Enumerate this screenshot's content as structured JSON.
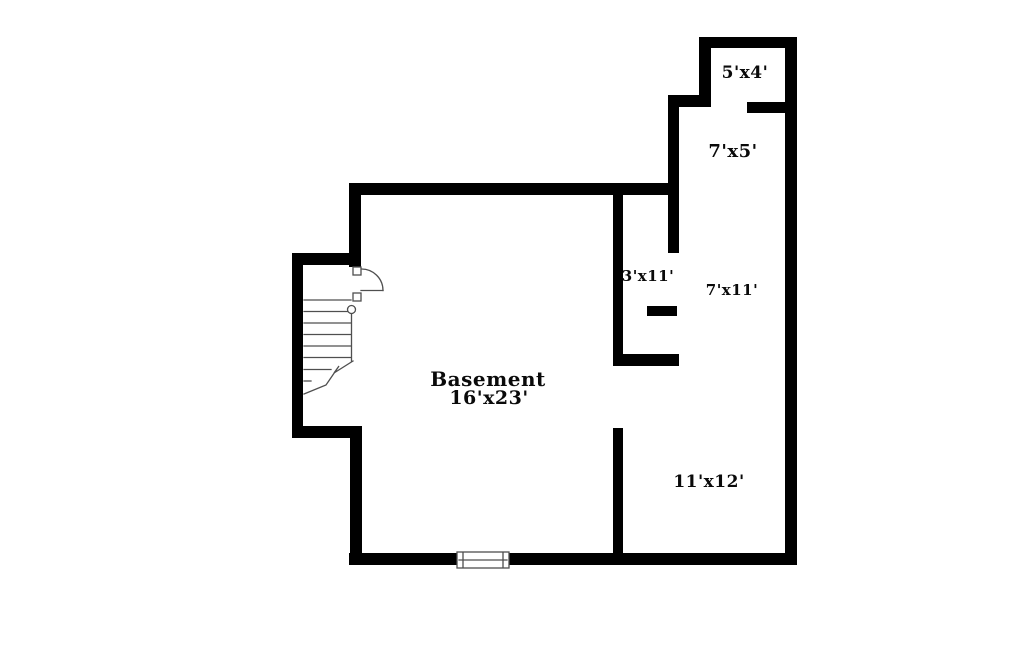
{
  "title": "Basement floor plan",
  "colors": {
    "wall": "#000000",
    "line": "#4f4f4f",
    "text": "#0a0a0a",
    "background": "#ffffff"
  },
  "rooms": {
    "basement": {
      "name": "Basement",
      "dims": "16'x23'"
    },
    "storage_top": {
      "dims": "5'x4'"
    },
    "hall_upper": {
      "dims": "7'x5'"
    },
    "closet": {
      "dims": "3'x11'"
    },
    "hall_side": {
      "dims": "7'x11'"
    },
    "rec_room": {
      "dims": "11'x12'"
    }
  }
}
